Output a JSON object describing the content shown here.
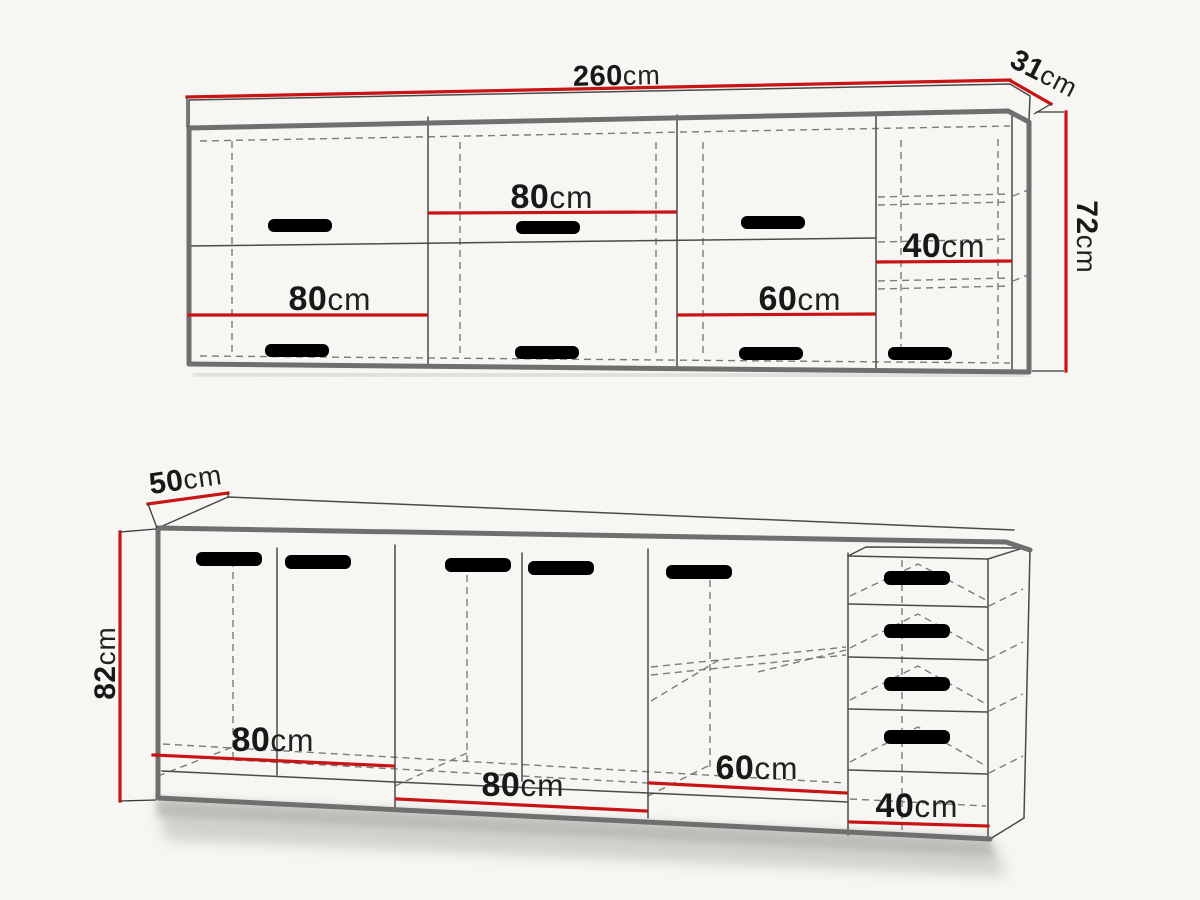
{
  "title": "Kitchen cabinet set dimension diagram",
  "colors": {
    "dimension_red": "#c81414",
    "outline_gray": "#6f6f6f",
    "background": "#f7f6f2"
  },
  "wall_unit": {
    "width": {
      "num": "260",
      "unit": "cm"
    },
    "depth": {
      "num": "31",
      "unit": "cm"
    },
    "height": {
      "num": "72",
      "unit": "cm"
    },
    "sections": [
      {
        "num": "80",
        "unit": "cm"
      },
      {
        "num": "80",
        "unit": "cm"
      },
      {
        "num": "60",
        "unit": "cm"
      },
      {
        "num": "40",
        "unit": "cm"
      }
    ]
  },
  "base_unit": {
    "depth": {
      "num": "50",
      "unit": "cm"
    },
    "height": {
      "num": "82",
      "unit": "cm"
    },
    "sections": [
      {
        "num": "80",
        "unit": "cm"
      },
      {
        "num": "80",
        "unit": "cm"
      },
      {
        "num": "60",
        "unit": "cm"
      },
      {
        "num": "40",
        "unit": "cm"
      }
    ]
  }
}
